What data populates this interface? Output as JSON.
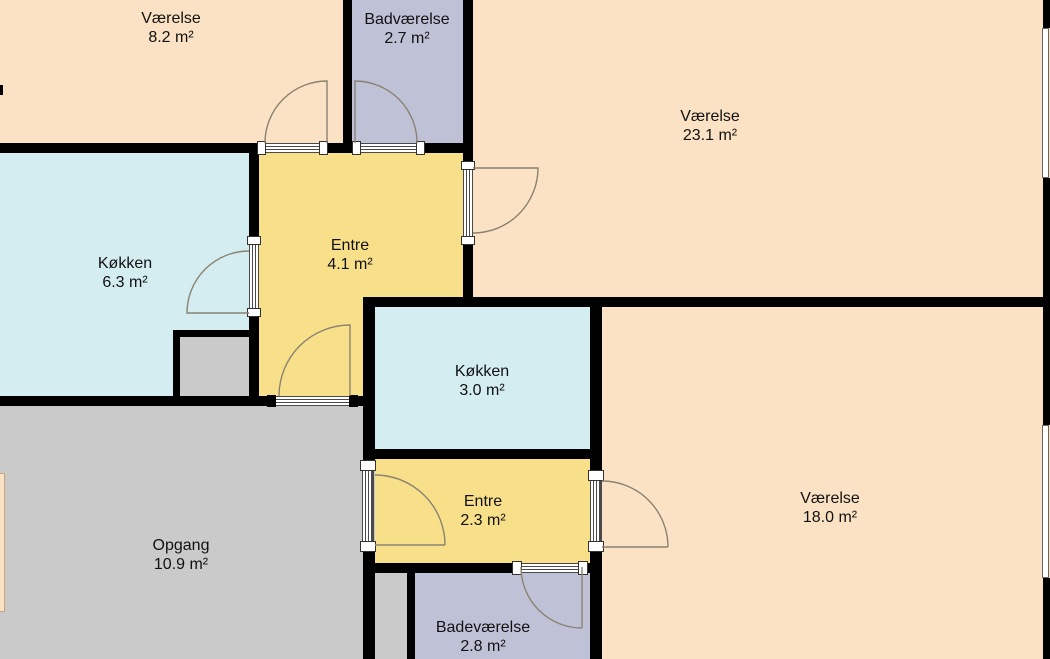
{
  "floorplan": {
    "title": "Apartment floor plan",
    "rooms": [
      {
        "id": "vaerelse-1",
        "name": "Værelse",
        "area": "8.2 m²"
      },
      {
        "id": "badvaerelse",
        "name": "Badværelse",
        "area": "2.7 m²"
      },
      {
        "id": "vaerelse-2",
        "name": "Værelse",
        "area": "23.1 m²"
      },
      {
        "id": "koekken-1",
        "name": "Køkken",
        "area": "6.3 m²"
      },
      {
        "id": "entre-1",
        "name": "Entre",
        "area": "4.1 m²"
      },
      {
        "id": "koekken-2",
        "name": "Køkken",
        "area": "3.0 m²"
      },
      {
        "id": "entre-2",
        "name": "Entre",
        "area": "2.3 m²"
      },
      {
        "id": "vaerelse-3",
        "name": "Værelse",
        "area": "18.0 m²"
      },
      {
        "id": "opgang",
        "name": "Opgang",
        "area": "10.9 m²"
      },
      {
        "id": "badevaerelse",
        "name": "Badeværelse",
        "area": "2.8 m²"
      }
    ],
    "colors": {
      "room_peach": "#FCE2C4",
      "room_purple": "#BFC2D7",
      "room_yellow": "#F8E08B",
      "room_blue": "#D4EDF1",
      "room_gray": "#CACACA",
      "wall": "#000000",
      "door_arc": "#8A8272",
      "label": "#111111"
    }
  }
}
